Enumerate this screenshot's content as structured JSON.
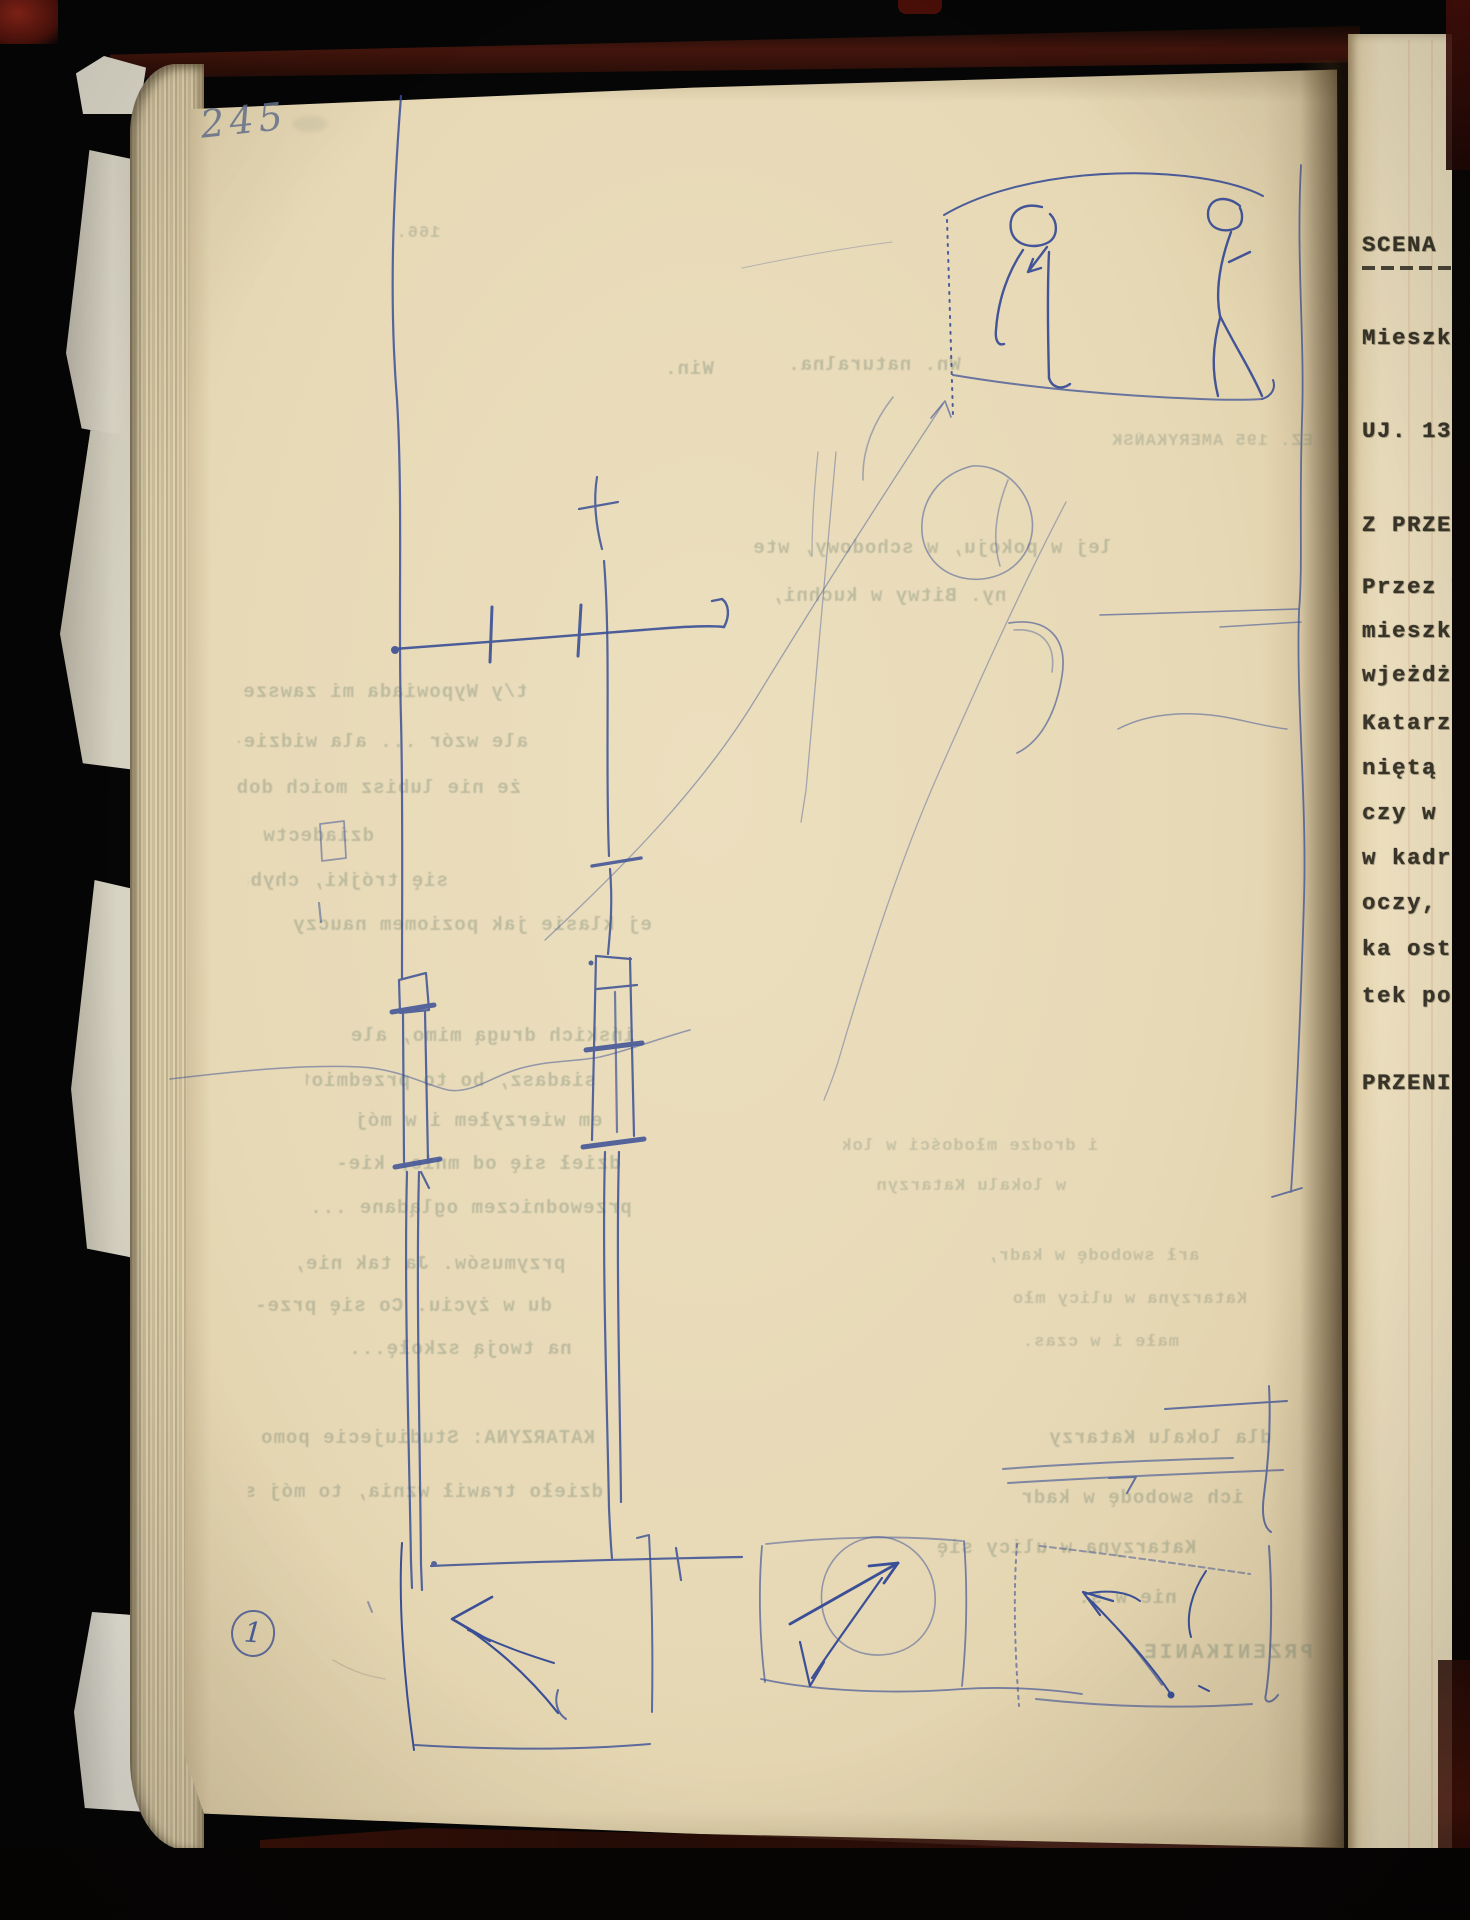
{
  "meta": {
    "description": "Photograph of an open screenplay notebook: left page 245 with blue ink storyboard sketches and mirrored bleed-through typescript, right page partially visible with Polish typewritten scene text",
    "object": "book-spread-photo"
  },
  "colors": {
    "paper": "#e9dcbd",
    "ink_blue": "#3a4f96",
    "typewriter": "#39352a",
    "ghost_text": "#7d8b78",
    "cover_maroon": "#4a170d",
    "background": "#060606"
  },
  "left_page": {
    "page_number": "245",
    "annotation_number": "1",
    "ghost_lines": [
      {
        "text": "166."
      },
      {
        "text": "Win."
      },
      {
        "text": "Wn. naturalna."
      },
      {
        "text": "EZ. 195 AMERYKAŃSK"
      },
      {
        "text": "lej w pokoju, w schodowy, wte-"
      },
      {
        "text": "ny. Bitwy w kuchni,"
      },
      {
        "text": "t/y Wypowiada mi zawsze"
      },
      {
        "text": "ale wzór ... ala widzie-"
      },
      {
        "text": "że nie lubisz moich dobrych"
      },
      {
        "text": "dziadectw."
      },
      {
        "text": "się trójki, chyba w"
      },
      {
        "text": "ej klasie jak poziomem nauczy"
      },
      {
        "text": "ińskich drugą mimo, ale"
      },
      {
        "text": "siadasz, bo to przedmiotów."
      },
      {
        "text": "em wierzyłem i w mój"
      },
      {
        "text": "dzieł się od mnie, kie-"
      },
      {
        "text": "przewodniczem oglądane ..."
      },
      {
        "text": "i drodze młodości w lokalnie"
      },
      {
        "text": "w lokalu Katarzyna."
      },
      {
        "text": "przymusów. Ja tak nie,"
      },
      {
        "text": "du w życiu. Co się prze-"
      },
      {
        "text": "na twoją szkołę..."
      },
      {
        "text": "arł swobodę w kadr,"
      },
      {
        "text": "Katarzyna w ulicy mło"
      },
      {
        "text": "małe i w czas."
      },
      {
        "text": "KATARZYNA: Studiujecie pomoc?"
      },
      {
        "text": "dzieło trawił wznia, to mój syn."
      },
      {
        "text": "dla lokalu Katarzy"
      },
      {
        "text": "ich swobodę w kadr"
      },
      {
        "text": "Katarzyna w ulicy się"
      },
      {
        "text": "nie w s."
      },
      {
        "text": "PRZENIKANIE"
      }
    ]
  },
  "right_page": {
    "lines": [
      {
        "text": "SCENA 8"
      },
      {
        "text": "Mieszka"
      },
      {
        "text": "UJ. 136"
      },
      {
        "text": "Z PRZEN"
      },
      {
        "text": "Przez W"
      },
      {
        "text": "mieszka"
      },
      {
        "text": "wjeżdżam"
      },
      {
        "text": "Katarzy"
      },
      {
        "text": "niętą d"
      },
      {
        "text": "czy w p"
      },
      {
        "text": "w kadr,"
      },
      {
        "text": "oczy, a"
      },
      {
        "text": "ka ostr"
      },
      {
        "text": "tek po"
      },
      {
        "text": "PRZENI"
      }
    ]
  }
}
